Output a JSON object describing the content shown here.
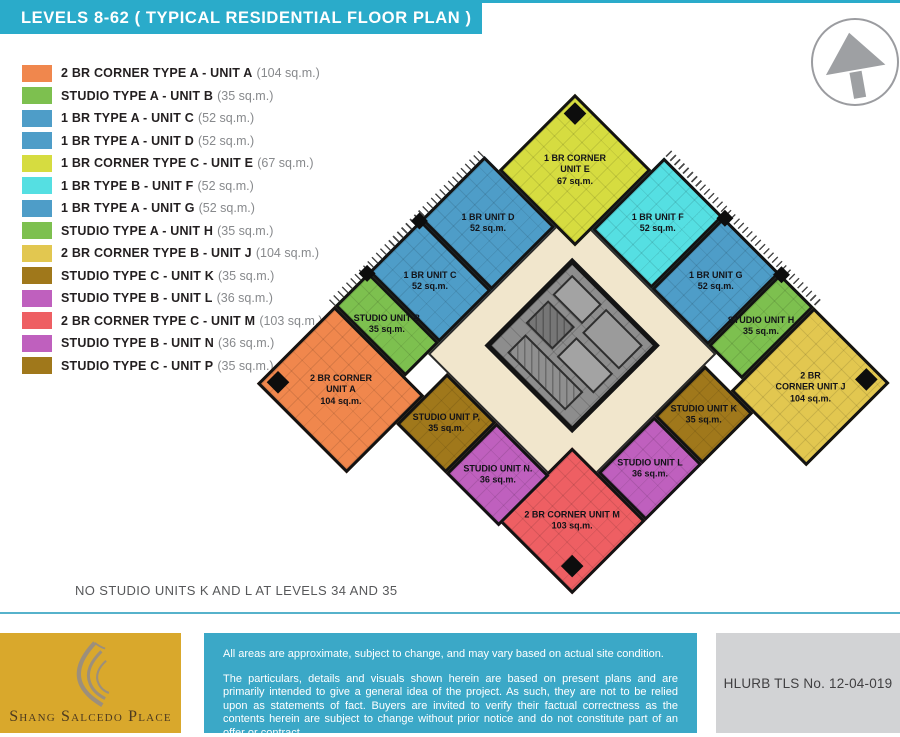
{
  "header": {
    "title": "LEVELS 8-62 ( TYPICAL RESIDENTIAL FLOOR PLAN )"
  },
  "colors": {
    "header_teal": "#2aabca",
    "divider_teal": "#56b2cb",
    "corridor_cream": "#f1e6cc",
    "core_gray": "#8d8d8d",
    "gold_box": "#d9a82c",
    "teal_box": "#3ba8c7",
    "gray_box": "#d2d3d5",
    "orange": "#f0874d",
    "green": "#7dc04f",
    "blue": "#4e9dc8",
    "lime": "#d6dc40",
    "cyan": "#55dfe2",
    "gold": "#e2c750",
    "dark_gold": "#a0781b",
    "orchid": "#bf60be",
    "red": "#ee5f63"
  },
  "north_arrow": {
    "name": "north-arrow",
    "color": "#9ea0a3"
  },
  "legend": {
    "items": [
      {
        "label": "2 BR CORNER TYPE A - UNIT A",
        "area": "(104 sq.m.)",
        "color": "#f0874d"
      },
      {
        "label": "STUDIO TYPE A - UNIT B",
        "area": "(35 sq.m.)",
        "color": "#7dc04f"
      },
      {
        "label": "1 BR TYPE A - UNIT C",
        "area": "(52 sq.m.)",
        "color": "#4e9dc8"
      },
      {
        "label": "1 BR TYPE A - UNIT D",
        "area": "(52 sq.m.)",
        "color": "#4e9dc8"
      },
      {
        "label": "1 BR CORNER TYPE C - UNIT E",
        "area": "(67 sq.m.)",
        "color": "#d6dc40"
      },
      {
        "label": "1 BR TYPE B - UNIT F",
        "area": "(52 sq.m.)",
        "color": "#55dfe2"
      },
      {
        "label": "1 BR TYPE A - UNIT G",
        "area": "(52 sq.m.)",
        "color": "#4e9dc8"
      },
      {
        "label": "STUDIO TYPE A - UNIT H",
        "area": "(35 sq.m.)",
        "color": "#7dc04f"
      },
      {
        "label": "2 BR CORNER TYPE B - UNIT J",
        "area": "(104 sq.m.)",
        "color": "#e2c750"
      },
      {
        "label": "STUDIO TYPE C - UNIT K",
        "area": "(35 sq.m.)",
        "color": "#a0781b"
      },
      {
        "label": "STUDIO TYPE B - UNIT L",
        "area": "(36 sq.m.)",
        "color": "#bf60be"
      },
      {
        "label": "2 BR CORNER TYPE C - UNIT M",
        "area": "(103 sq.m.)",
        "color": "#ee5f63"
      },
      {
        "label": "STUDIO TYPE B - UNIT N",
        "area": "(36 sq.m.)",
        "color": "#bf60be"
      },
      {
        "label": "STUDIO TYPE C - UNIT P",
        "area": "(35 sq.m.)",
        "color": "#a0781b"
      }
    ]
  },
  "plan": {
    "note": "NO STUDIO UNITS K AND L AT LEVELS 34 AND 35",
    "units": [
      {
        "id": "unit-e",
        "color": "#d6dc40",
        "lines": [
          "1 BR CORNER",
          "UNIT E",
          "67 sq.m."
        ]
      },
      {
        "id": "unit-d",
        "color": "#4e9dc8",
        "lines": [
          "1 BR UNIT D",
          "52 sq.m."
        ]
      },
      {
        "id": "unit-c",
        "color": "#4e9dc8",
        "lines": [
          "1 BR UNIT C",
          "52 sq.m."
        ]
      },
      {
        "id": "unit-b",
        "color": "#7dc04f",
        "lines": [
          "STUDIO UNIT B",
          "35 sq.m."
        ]
      },
      {
        "id": "unit-a",
        "color": "#f0874d",
        "lines": [
          "2 BR CORNER",
          "UNIT A",
          "104 sq.m."
        ]
      },
      {
        "id": "unit-f",
        "color": "#55dfe2",
        "lines": [
          "1 BR UNIT F",
          "52 sq.m."
        ]
      },
      {
        "id": "unit-g",
        "color": "#4e9dc8",
        "lines": [
          "1 BR UNIT G",
          "52 sq.m."
        ]
      },
      {
        "id": "unit-h",
        "color": "#7dc04f",
        "lines": [
          "STUDIO UNIT H",
          "35 sq.m."
        ]
      },
      {
        "id": "unit-j",
        "color": "#e2c750",
        "lines": [
          "2 BR",
          "CORNER UNIT J",
          "104 sq.m."
        ]
      },
      {
        "id": "unit-k",
        "color": "#a0781b",
        "lines": [
          "STUDIO UNIT K",
          "35 sq.m."
        ]
      },
      {
        "id": "unit-l",
        "color": "#bf60be",
        "lines": [
          "STUDIO UNIT L",
          "36 sq.m."
        ]
      },
      {
        "id": "unit-m",
        "color": "#ee5f63",
        "lines": [
          "2 BR CORNER UNIT M",
          "103 sq.m."
        ]
      },
      {
        "id": "unit-n",
        "color": "#bf60be",
        "lines": [
          "STUDIO UNIT N.",
          "36 sq.m."
        ]
      },
      {
        "id": "unit-p",
        "color": "#a0781b",
        "lines": [
          "STUDIO UNIT P,",
          "35 sq.m."
        ]
      }
    ]
  },
  "footer": {
    "brand": "Shang Salcedo Place",
    "disclaimer": {
      "p1": "All areas are approximate, subject to change, and may vary based on actual site condition.",
      "p2": "The particulars, details and visuals shown herein are based on present plans and are primarily intended to give a general idea of the project. As such, they are not to be relied upon as statements of fact.  Buyers are invited to verify their factual correctness as the contents herein are subject to change without prior notice and do not constitute part of an offer or contract."
    },
    "hlurb": "HLURB TLS No. 12-04-019"
  }
}
